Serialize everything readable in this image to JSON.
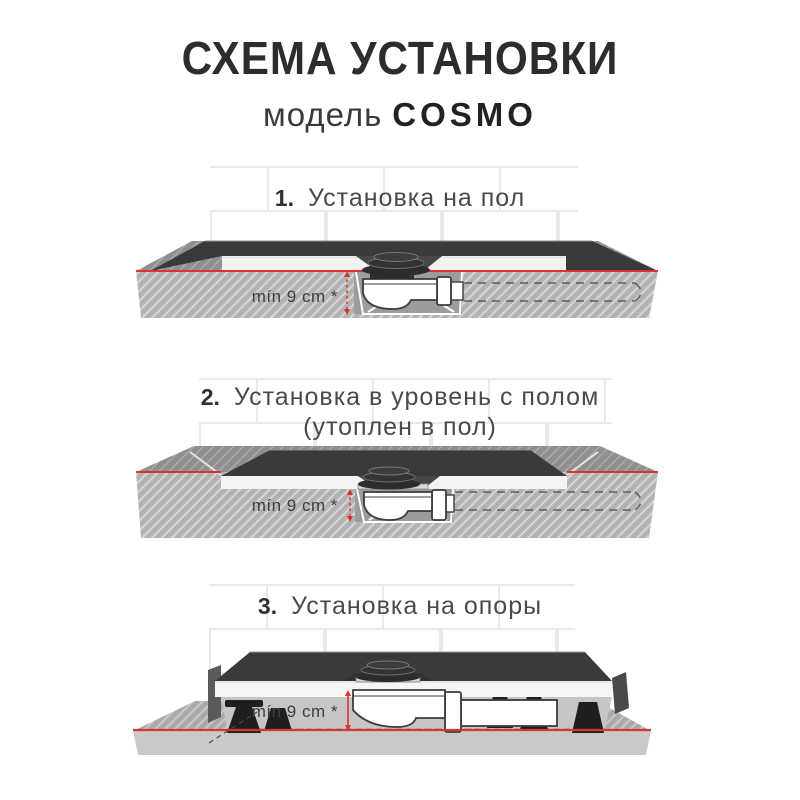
{
  "header": {
    "title": "СХЕМА УСТАНОВКИ",
    "model_label": "модель",
    "model_name": "COSMO"
  },
  "sections": [
    {
      "number": "1.",
      "title": "Установка на пол",
      "min_label": "mín 9 cm *"
    },
    {
      "number": "2.",
      "title": "Установка в уровень с полом",
      "title_line2": "(утоплен в пол)",
      "min_label": "mín 9 cm *"
    },
    {
      "number": "3.",
      "title": "Установка на опоры",
      "min_label": "mín 9 cm *"
    }
  ],
  "colors": {
    "accent_red": "#d93434",
    "slab_gray": "#b6b6b6",
    "floor_top_gray": "#8f8f8f",
    "tray_dark": "#3a3a3a",
    "tray_edge_white": "#f3f3f1",
    "tile_grout": "#e9e9e9",
    "text_dark": "#2d2d2d"
  }
}
